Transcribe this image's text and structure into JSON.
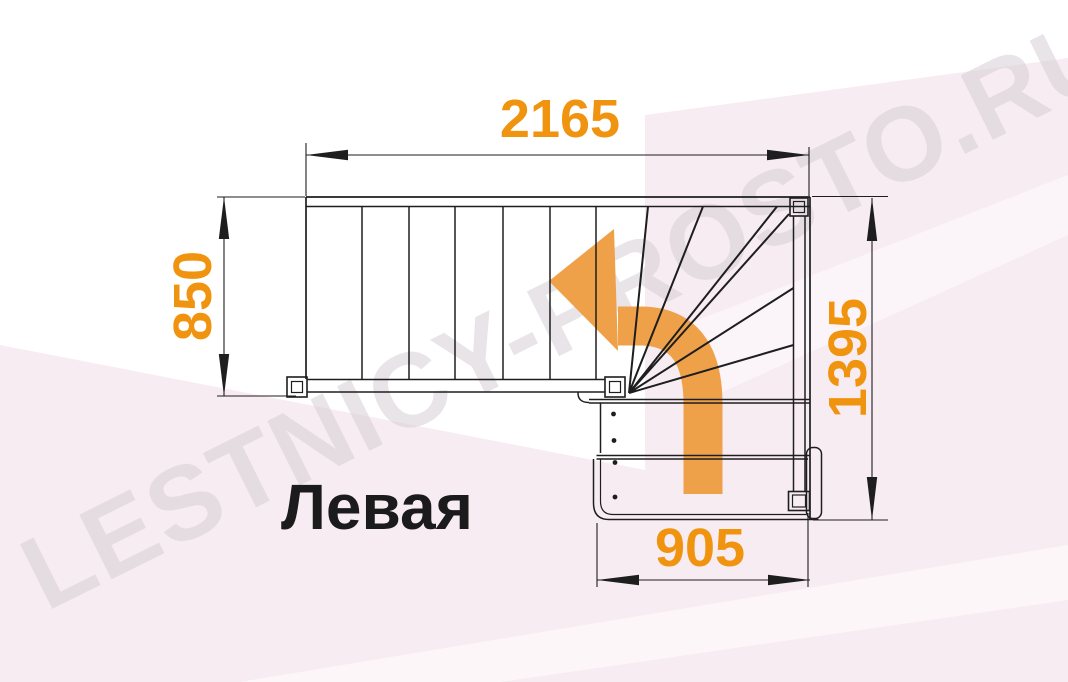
{
  "diagram": {
    "label": "Левая",
    "watermark": "LESTNICY-PROSTO.RU",
    "dimensions": {
      "top": "2165",
      "left": "850",
      "right": "1395",
      "bottom": "905"
    },
    "icons": {
      "direction_arrow": "curved-arrow-up-then-left"
    },
    "colors": {
      "dimension_text_orange": "#F0930E",
      "direction_arrow_orange": "#EFA149",
      "drawing_line_black": "#1E1E1E",
      "watermark_gray": "#D8D2D7",
      "background_tint_pink": "#F8ECF3"
    }
  }
}
